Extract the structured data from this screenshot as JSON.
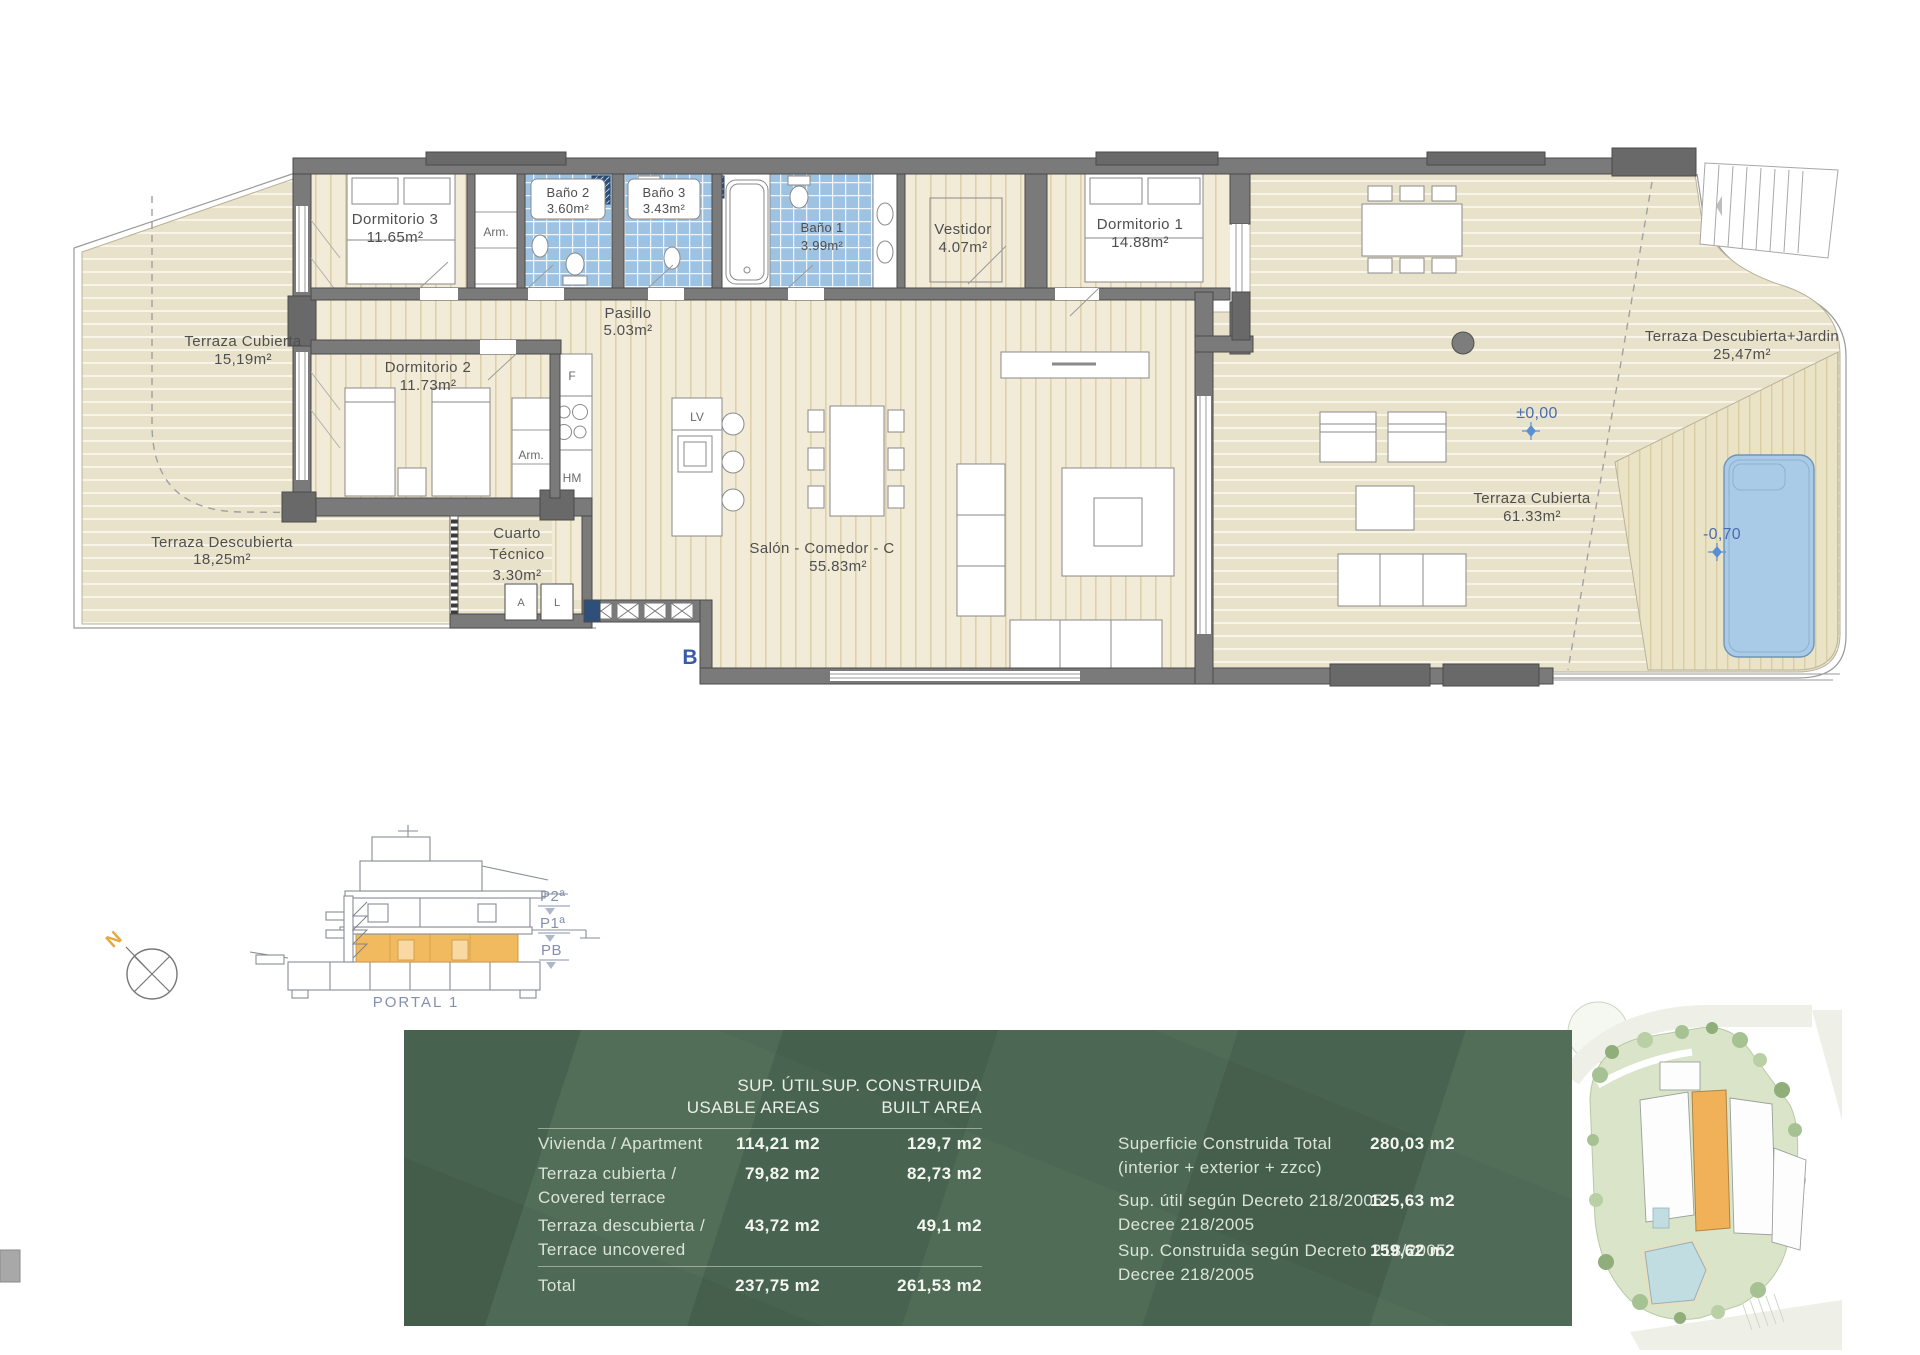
{
  "plan": {
    "rooms": [
      {
        "name": "Dormitorio 3",
        "area": "11.65m²"
      },
      {
        "name": "Baño 2",
        "area": "3.60m²"
      },
      {
        "name": "Baño 3",
        "area": "3.43m²"
      },
      {
        "name": "Baño 1",
        "area": "3.99m²"
      },
      {
        "name": "Vestidor",
        "area": "4.07m²"
      },
      {
        "name": "Dormitorio 1",
        "area": "14.88m²"
      },
      {
        "name": "Terraza  Cubierta",
        "area": "15,19m²"
      },
      {
        "name": "Dormitorio 2",
        "area": "11.73m²"
      },
      {
        "name": "Pasillo",
        "area": "5.03m²"
      },
      {
        "name": "Terraza  Descubierta",
        "area": "18,25m²"
      },
      {
        "name": "Cuarto",
        "name2": "Técnico",
        "area": "3.30m²"
      },
      {
        "name": "Salón - Comedor - C",
        "area": "55.83m²"
      },
      {
        "name": "Terraza  Cubierta",
        "area": "61.33m²"
      },
      {
        "name": "Terraza  Descubierta+Jardin",
        "area": "25,47m²"
      }
    ],
    "marks": {
      "closet": "Arm.",
      "closet2": "Arm.",
      "fridge": "F",
      "dishwasher": "LV",
      "hm": "HM",
      "washer": "A",
      "dryer": "L",
      "section": "B",
      "level_main": "±0,00",
      "level_pool": "-0,70"
    }
  },
  "section": {
    "levels": [
      "P2ª",
      "P1ª",
      "PB"
    ],
    "caption": "PORTAL 1",
    "north": "N"
  },
  "summary_table": {
    "headers": {
      "useful_line1": "SUP. ÚTIL",
      "useful_line2": "USABLE AREAS",
      "built_line1": "SUP. CONSTRUIDA",
      "built_line2": "BUILT AREA"
    },
    "rows": [
      {
        "label": "Vivienda / Apartment",
        "label2": "",
        "useful": "114,21 m2",
        "built": "129,7 m2"
      },
      {
        "label": "Terraza cubierta /",
        "label2": "Covered terrace",
        "useful": "79,82 m2",
        "built": "82,73 m2"
      },
      {
        "label": "Terraza descubierta /",
        "label2": "Terrace uncovered",
        "useful": "43,72 m2",
        "built": "49,1 m2"
      }
    ],
    "total": {
      "label": "Total",
      "useful": "237,75 m2",
      "built": "261,53 m2"
    },
    "details": [
      {
        "label": "Superficie Construida Total",
        "label2": "(interior + exterior + zzcc)",
        "value": "280,03 m2"
      },
      {
        "label": "Sup. útil según Decreto 218/2005",
        "label2": "Decree 218/2005",
        "value": "125,63 m2"
      },
      {
        "label": "Sup. Construida según Decreto 218/2005",
        "label2": "Decree 218/2005",
        "value": "159,62 m2"
      }
    ]
  },
  "colors": {
    "panel_green": "#4C6954",
    "accent_orange": "#F0B85C",
    "level_blue": "#4A6CAE",
    "section_label_blue": "#8590AD",
    "tile_blue": "#9DC2E2"
  }
}
